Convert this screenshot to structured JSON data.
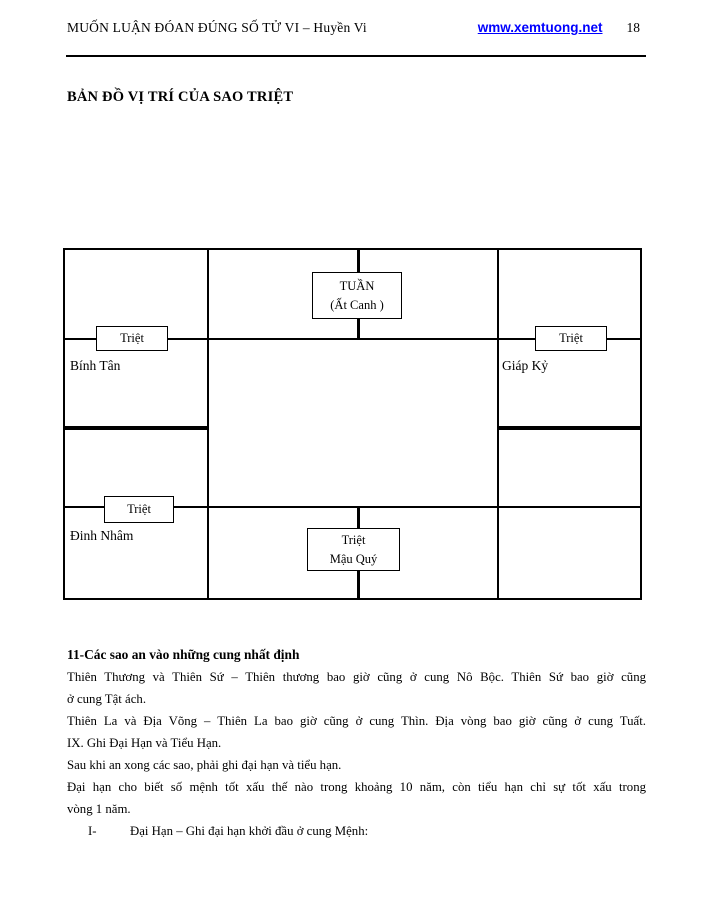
{
  "header": {
    "title": "MUỐN LUẬN ĐÓAN ĐÚNG SỐ TỬ VI – Huyền Vi",
    "link": "wmw.xemtuong.net",
    "page_number": "18"
  },
  "section_title": "BẢN ĐỒ VỊ TRÍ CỦA SAO TRIỆT",
  "colors": {
    "link": "#0000ff",
    "text": "#000000",
    "line": "#000000",
    "background": "#ffffff"
  },
  "diagram": {
    "tuan_box": {
      "line1": "TUẦN",
      "line2": "(Ất Canh )"
    },
    "triet_top_left": "Triệt",
    "triet_top_right": "Triệt",
    "triet_bottom_left": "Triệt",
    "bottom_box": {
      "line1": "Triệt",
      "line2": "Mậu Quý"
    },
    "labels": {
      "binh_tan": "Bính Tân",
      "giap_ky": "Giáp Kỷ",
      "dinh_nham": "Đinh Nhâm"
    }
  },
  "body": {
    "heading": "11-Các sao an vào những cung nhất định",
    "lines": [
      "Thiên Thương và Thiên Sứ – Thiên thương bao giờ cũng ở cung Nô Bộc. Thiên Sứ bao giờ cũng",
      "ở cung Tật ách.",
      "Thiên La và Địa Võng – Thiên La bao giờ cũng ở cung Thìn. Địa vòng bao giờ cũng ở cung Tuất.",
      "IX. Ghi Đại Hạn và Tiểu Hạn.",
      "Sau khi an xong các sao, phải ghi đại hạn và tiểu hạn.",
      "Đại hạn cho biết số mệnh tốt xấu thế nào trong khoảng 10 năm, còn tiểu hạn chỉ sự tốt xấu trong",
      "vòng 1 năm."
    ],
    "list_item": {
      "marker": "I-",
      "text": "Đại Hạn – Ghi đại hạn khởi đầu ở cung Mệnh:"
    }
  }
}
